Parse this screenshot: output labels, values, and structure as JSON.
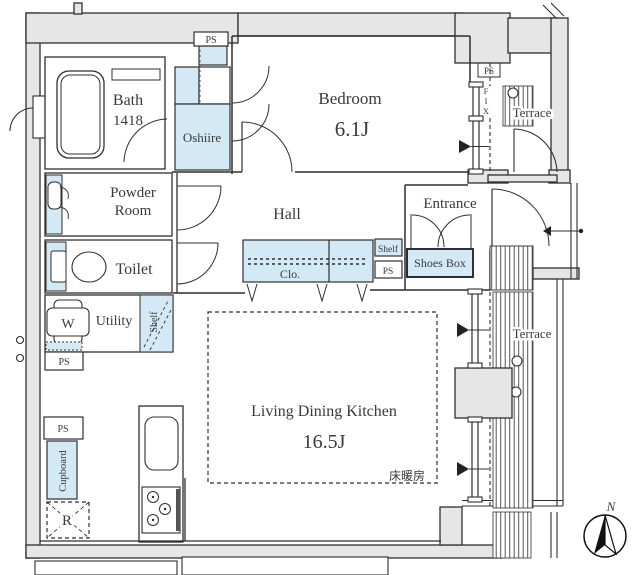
{
  "colors": {
    "fixture_fill": "#d3e9f5",
    "wall_fill": "#e6e6e6",
    "line": "#2f2f2f",
    "text": "#3a3a3a"
  },
  "rooms": {
    "bath": {
      "name": "Bath",
      "size": "1418"
    },
    "oshiire": {
      "name": "Oshiire"
    },
    "bedroom": {
      "name": "Bedroom",
      "size": "6.1J"
    },
    "terrace_top": {
      "name": "Terrace"
    },
    "powder": {
      "line1": "Powder",
      "line2": "Room"
    },
    "toilet": {
      "name": "Toilet"
    },
    "hall": {
      "name": "Hall"
    },
    "entrance": {
      "name": "Entrance"
    },
    "utility": {
      "name": "Utility"
    },
    "ldk": {
      "name": "Living Dining Kitchen",
      "size": "16.5J"
    },
    "terrace_right": {
      "name": "Terrace"
    }
  },
  "features": {
    "closet": "Clo.",
    "shoes_box": "Shoes Box",
    "shelf_hall": "Shelf",
    "shelf_utility": "Shelf",
    "cupboard": "Cupboard",
    "refrigerator": "R",
    "washer": "W",
    "floor_heating": "床暖房",
    "fix_window": "FIX"
  },
  "pipe_space": {
    "top": "PS",
    "bedroom_corner": "PS",
    "hall": "PS",
    "left_upper": "PS",
    "left_lower": "PS"
  },
  "compass": {
    "north": "N"
  }
}
